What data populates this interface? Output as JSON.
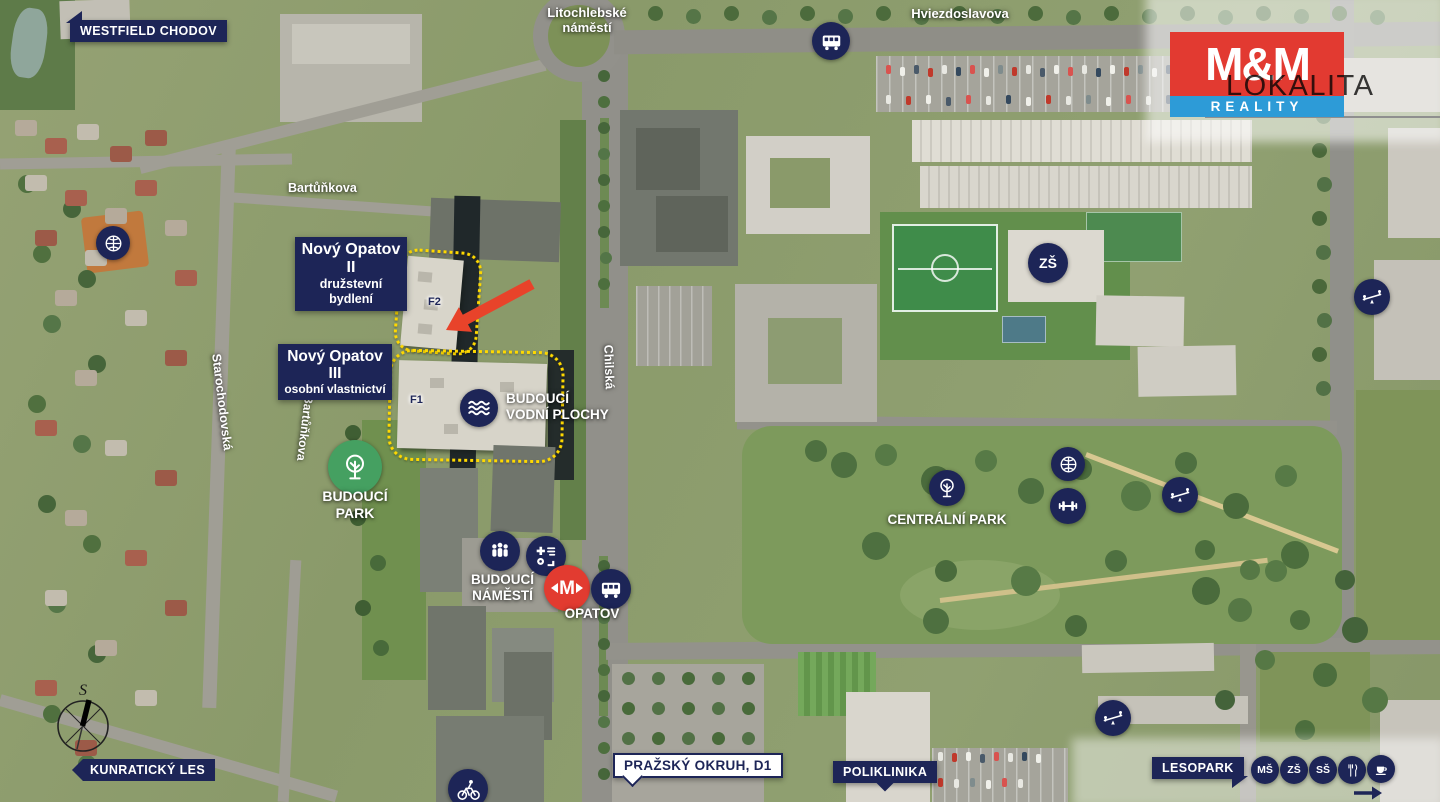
{
  "meta": {
    "region_title": "LOKALITA"
  },
  "logo": {
    "line1": "M&M",
    "line2": "REALITY"
  },
  "colors": {
    "navy": "#1d2557",
    "red": "#e23b30",
    "blue": "#2d9bd7",
    "yellow": "#ffd900",
    "green": "#45a061"
  },
  "streets": {
    "litochlebske_line1": "Litochlebské",
    "litochlebske_line2": "náměstí",
    "hviezdoslavova": "Hviezdoslavova",
    "bartunkova": "Bartůňkova",
    "bartunkova_vertical": "Bartůňkova",
    "starochodovska": "Starochodovská",
    "chilska": "Chilská"
  },
  "banners": {
    "westfield_chodov": "WESTFIELD CHODOV",
    "kunraticky_les": "KUNRATICKÝ LES",
    "prazsky_okruh_d1": "PRAŽSKÝ OKRUH, D1",
    "poliklinika": "POLIKLINIKA",
    "lesopark": "LESOPARK"
  },
  "projects": {
    "opatov2_title": "Nový Opatov II",
    "opatov2_subtitle": "družstevní bydlení",
    "opatov3_title": "Nový Opatov III",
    "opatov3_subtitle": "osobní vlastnictví",
    "building_f1": "F1",
    "building_f2": "F2"
  },
  "poi": {
    "vodni_line1": "BUDOUCÍ",
    "vodni_line2": "VODNÍ PLOCHY",
    "park_line1": "BUDOUCÍ",
    "park_line2": "PARK",
    "namesti_line1": "BUDOUCÍ",
    "namesti_line2": "NÁMĚSTÍ",
    "opatov_station": "OPATOV",
    "centralni_park": "CENTRÁLNÍ PARK"
  },
  "badges": {
    "ms": "MŠ",
    "zs": "ZŠ",
    "ss": "SŠ",
    "zs_school": "ZŠ",
    "metro_m": "M"
  },
  "compass": {
    "north_label": "S"
  },
  "icons": [
    "bus-icon",
    "tree-icon",
    "waves-icon",
    "people-icon",
    "services-icon",
    "metro-icon",
    "basketball-icon",
    "dumbbell-icon",
    "seesaw-icon",
    "bicycle-icon",
    "cutlery-icon",
    "coffee-icon",
    "compass-icon",
    "arrow-icon"
  ]
}
